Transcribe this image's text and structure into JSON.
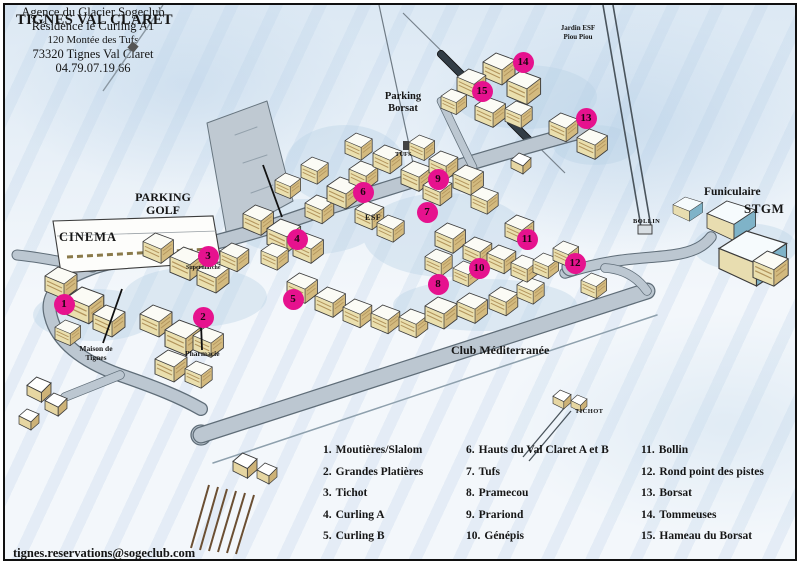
{
  "title": "TIGNES VAL CLARET",
  "agency_block": {
    "line1": "Agence du Glacier Sogeclub",
    "line2": "Résidence le Curling A1",
    "line3": "120 Montée des Tufs",
    "line4": "73320 Tignes Val Claret",
    "line5": "04.79.07.19.66"
  },
  "map_labels": {
    "parking_golf": "PARKING\nGOLF",
    "cinema": "CINEMA",
    "parking_borsat": "Parking\nBorsat",
    "jardin_esf": "Jardin ESF\nPiou Piou",
    "funiculaire": "Funiculaire",
    "stgm": "STGM",
    "bollin": "BOLLIN",
    "tufs": "TUFS",
    "esf": "ESF",
    "supermarche": "Supermarché",
    "maison_de_tignes": "Maison de\nTignes",
    "pharmacie": "Pharmacie",
    "club_mediterranee": "Club Méditerranée",
    "tichot": "TICHOT"
  },
  "markers": [
    {
      "num": "1",
      "x": 59,
      "y": 299
    },
    {
      "num": "2",
      "x": 198,
      "y": 312
    },
    {
      "num": "3",
      "x": 203,
      "y": 251
    },
    {
      "num": "4",
      "x": 292,
      "y": 234
    },
    {
      "num": "5",
      "x": 288,
      "y": 294
    },
    {
      "num": "6",
      "x": 358,
      "y": 187
    },
    {
      "num": "7",
      "x": 422,
      "y": 207
    },
    {
      "num": "8",
      "x": 433,
      "y": 279
    },
    {
      "num": "9",
      "x": 433,
      "y": 174
    },
    {
      "num": "10",
      "x": 474,
      "y": 263
    },
    {
      "num": "11",
      "x": 522,
      "y": 234
    },
    {
      "num": "12",
      "x": 570,
      "y": 258
    },
    {
      "num": "13",
      "x": 581,
      "y": 113
    },
    {
      "num": "14",
      "x": 518,
      "y": 57
    },
    {
      "num": "15",
      "x": 477,
      "y": 86
    }
  ],
  "legend": {
    "items": [
      {
        "num": "1.",
        "label": "Moutières/Slalom"
      },
      {
        "num": "2.",
        "label": "Grandes Platières"
      },
      {
        "num": "3.",
        "label": "Tichot"
      },
      {
        "num": "4.",
        "label": "Curling A"
      },
      {
        "num": "5.",
        "label": "Curling B"
      },
      {
        "num": "6.",
        "label": "Hauts du Val Claret A et B"
      },
      {
        "num": "7.",
        "label": "Tufs"
      },
      {
        "num": "8.",
        "label": "Pramecou"
      },
      {
        "num": "9.",
        "label": "Prariond"
      },
      {
        "num": "10.",
        "label": "Génépis"
      },
      {
        "num": "11.",
        "label": "Bollin"
      },
      {
        "num": "12.",
        "label": "Rond point des pistes"
      },
      {
        "num": "13.",
        "label": "Borsat"
      },
      {
        "num": "14.",
        "label": "Tommeuses"
      },
      {
        "num": "15.",
        "label": "Hameau du Borsat"
      }
    ]
  },
  "footer": {
    "email": "tignes.reservations@sogeclub.com"
  },
  "colors": {
    "marker": "#e6128e",
    "road": "#bcc7d1",
    "road_edge": "#60707b",
    "building": "#eadfae"
  }
}
